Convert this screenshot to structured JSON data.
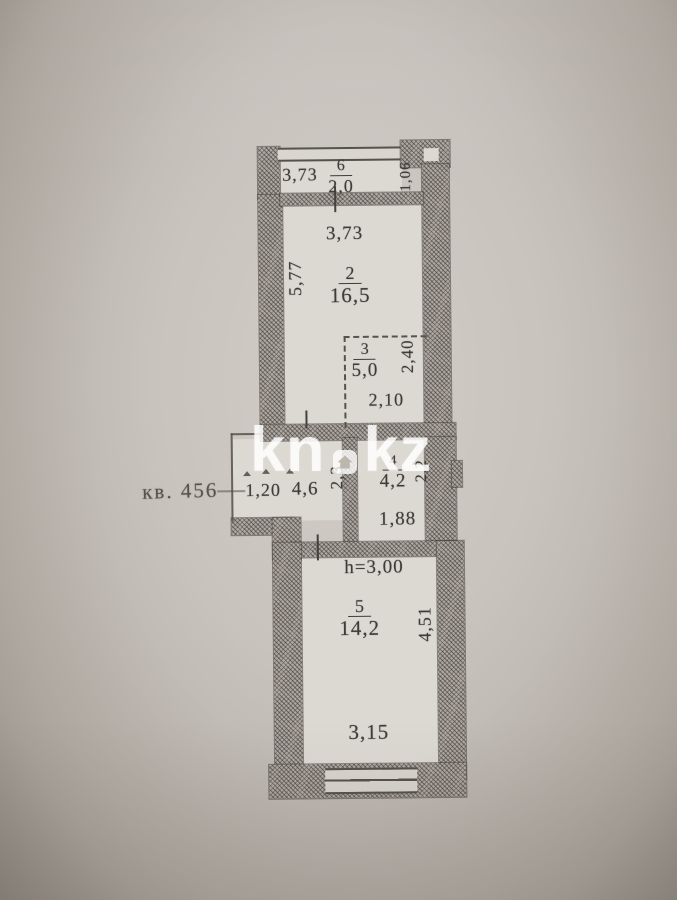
{
  "photo": {
    "background_color": "#c7c1ba",
    "paper_color": "#dcd8d2",
    "wall_color": "#aea8a1",
    "line_color": "#45413c"
  },
  "watermark": {
    "left": "kn",
    "right": "kz",
    "dot_icon": "house-icon",
    "color": "#ffffff"
  },
  "plan": {
    "apartment_label": "кв. 456",
    "balcony": {
      "number": "6",
      "area": "2,0",
      "width": "3,73",
      "depth": "1,06"
    },
    "room2": {
      "number": "2",
      "area": "16,5",
      "width": "3,73",
      "height": "5,77"
    },
    "room3": {
      "number": "3",
      "area": "5,0",
      "width": "2,10",
      "height": "2,40"
    },
    "hall": {
      "area": "4,6",
      "entry_width": "1,20",
      "height": "2,3"
    },
    "room4": {
      "number": "4",
      "area": "4,2",
      "width": "1,88",
      "height": "2,2"
    },
    "room5": {
      "number": "5",
      "area": "14,2",
      "width": "3,15",
      "height": "4,51",
      "ceiling_height": "h=3,00"
    }
  }
}
